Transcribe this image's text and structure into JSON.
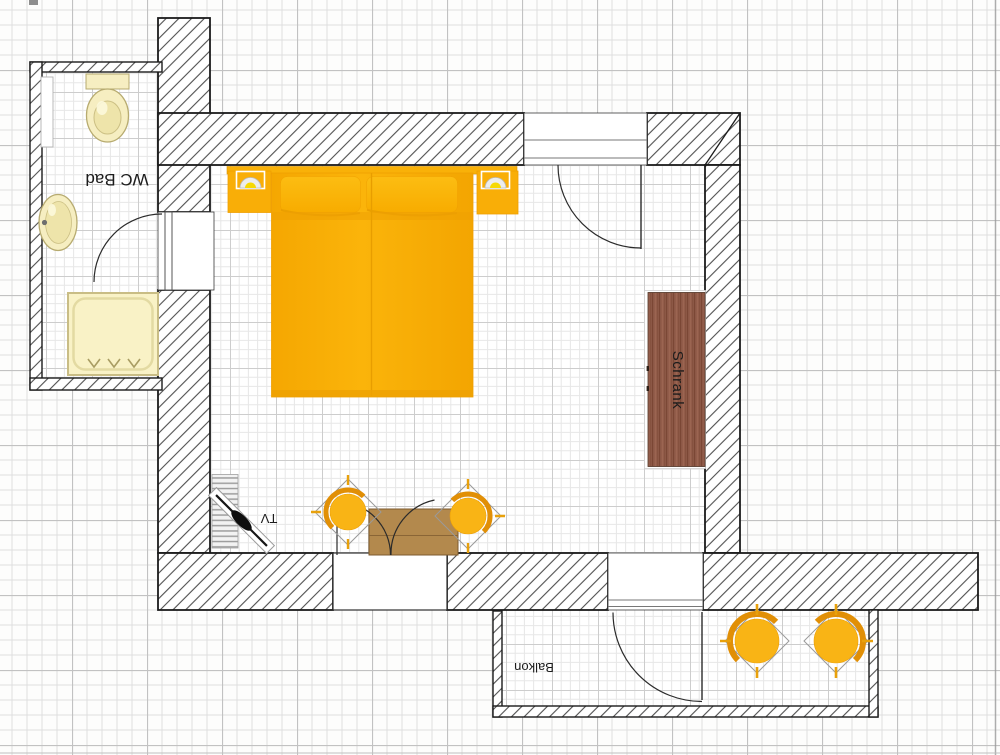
{
  "labels": {
    "bathroom": "WC Bad",
    "wardrobe": "Schrank",
    "tv": "TV",
    "balcony": "Balkon"
  },
  "rooms": [
    {
      "name": "bathroom",
      "label": "WC Bad"
    },
    {
      "name": "main-room",
      "label": ""
    },
    {
      "name": "balcony",
      "label": "Balkon"
    }
  ],
  "furniture": [
    "double-bed",
    "nightstand-left",
    "nightstand-right",
    "bed-lamp-left",
    "bed-lamp-right",
    "wardrobe",
    "table",
    "table-chair-left",
    "table-chair-right",
    "tv",
    "tv-stand",
    "toilet",
    "sink",
    "shower",
    "radiator",
    "balcony-chair-left",
    "balcony-chair-right"
  ],
  "colors": {
    "furniture_orange": "#F9AF05",
    "chair_orange": "#F9B415",
    "table_wood": "#B3894D",
    "wardrobe_wood": "#8E5947",
    "fixture_cream": "#F6EEC1",
    "wall_hatch_line": "#4F4F4F",
    "paper_grid": "#DEDEDE",
    "room_grid": "#E7E7E7"
  }
}
